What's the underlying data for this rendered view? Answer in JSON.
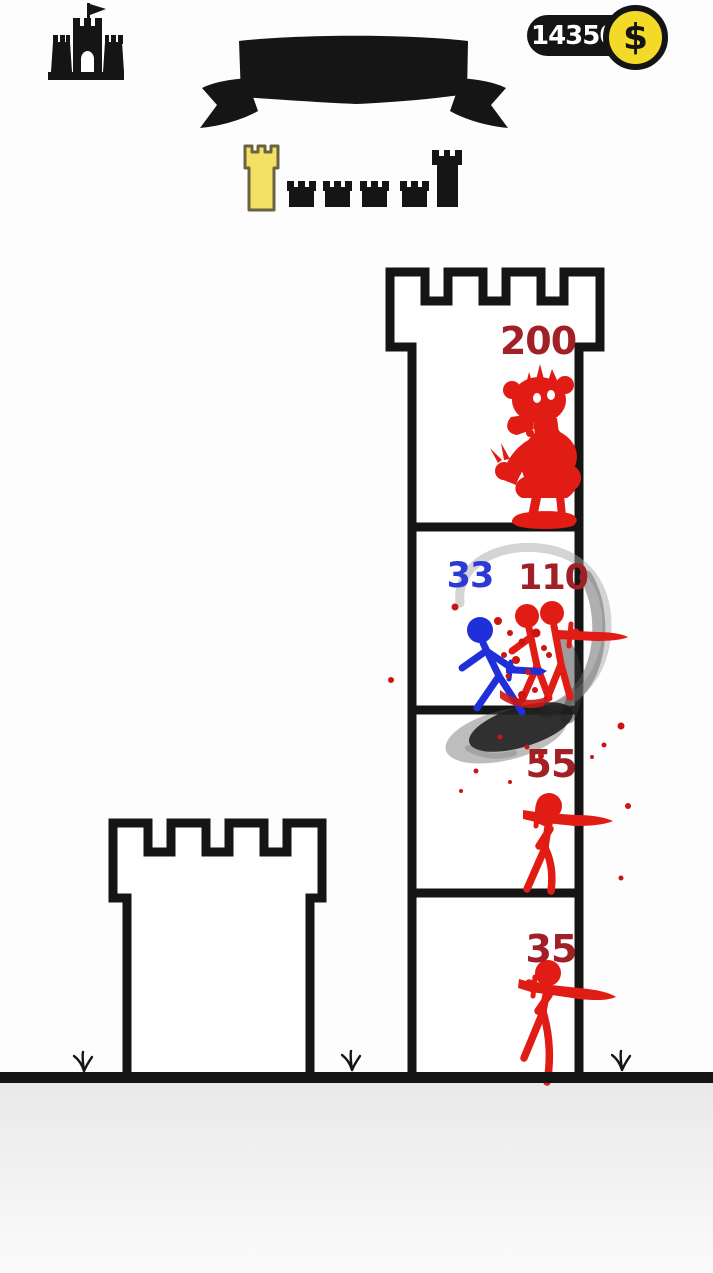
{
  "header": {
    "coin_counter": {
      "value": "14350",
      "symbol": "$"
    }
  },
  "icons": {
    "castle_button": "castle-icon",
    "coin": "dollar-coin-icon",
    "banner": "ribbon-banner",
    "grass": "grass-tuft"
  },
  "colors": {
    "ink": "#151515",
    "red": "#e11c14",
    "dark_red": "#a02025",
    "blue": "#2030d8",
    "blue_text": "#2b3ad2",
    "tower_yellow": "#f3e065",
    "coin_yellow": "#f3d928"
  },
  "level_progress": {
    "towers": [
      {
        "kind": "current-level-yellow"
      },
      {
        "kind": "upcoming-small"
      },
      {
        "kind": "upcoming-small"
      },
      {
        "kind": "upcoming-small"
      },
      {
        "kind": "upcoming-small"
      },
      {
        "kind": "final-tall"
      }
    ]
  },
  "battlefield": {
    "player_tower": {
      "occupant": "empty"
    },
    "enemy_tower": {
      "floors": [
        {
          "name": "top-boss-floor",
          "hp": "200",
          "occupant": "red-boss-monster"
        },
        {
          "name": "battle-floor",
          "attacker_hp": "33",
          "hp": "110",
          "occupant": "blue-warrior-vs-red-swordsmen"
        },
        {
          "name": "third-floor",
          "hp": "55",
          "occupant": "red-swordsman"
        },
        {
          "name": "ground-floor",
          "hp": "35",
          "occupant": "red-swordsman"
        }
      ]
    }
  }
}
